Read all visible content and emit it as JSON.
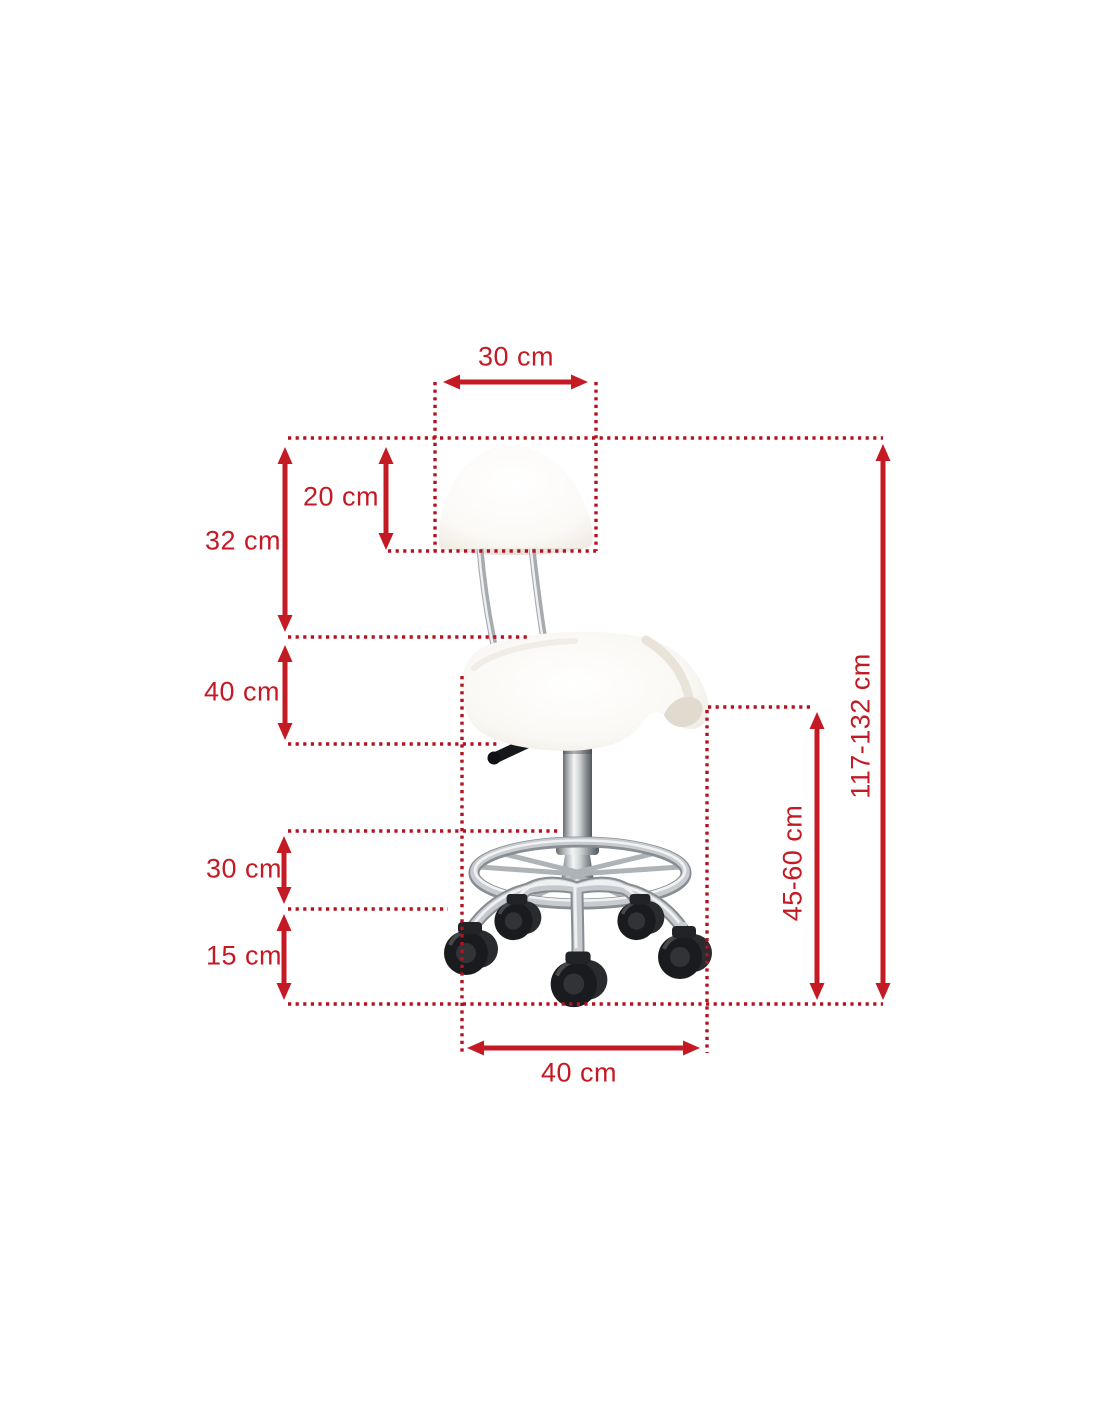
{
  "background_color": "#ffffff",
  "colors": {
    "dotted_line": "#b5121f",
    "arrow": "#c41a24",
    "label_text": "#c41a24"
  },
  "dimensions": {
    "backrest_width": "30 cm",
    "backrest_height": "20 cm",
    "backrest_section_height": "32 cm",
    "seat_section_height": "40 cm",
    "footrest_section_height": "30 cm",
    "base_section_height": "15 cm",
    "total_height": "117-132 cm",
    "seat_height": "45-60 cm",
    "base_width": "40 cm"
  }
}
